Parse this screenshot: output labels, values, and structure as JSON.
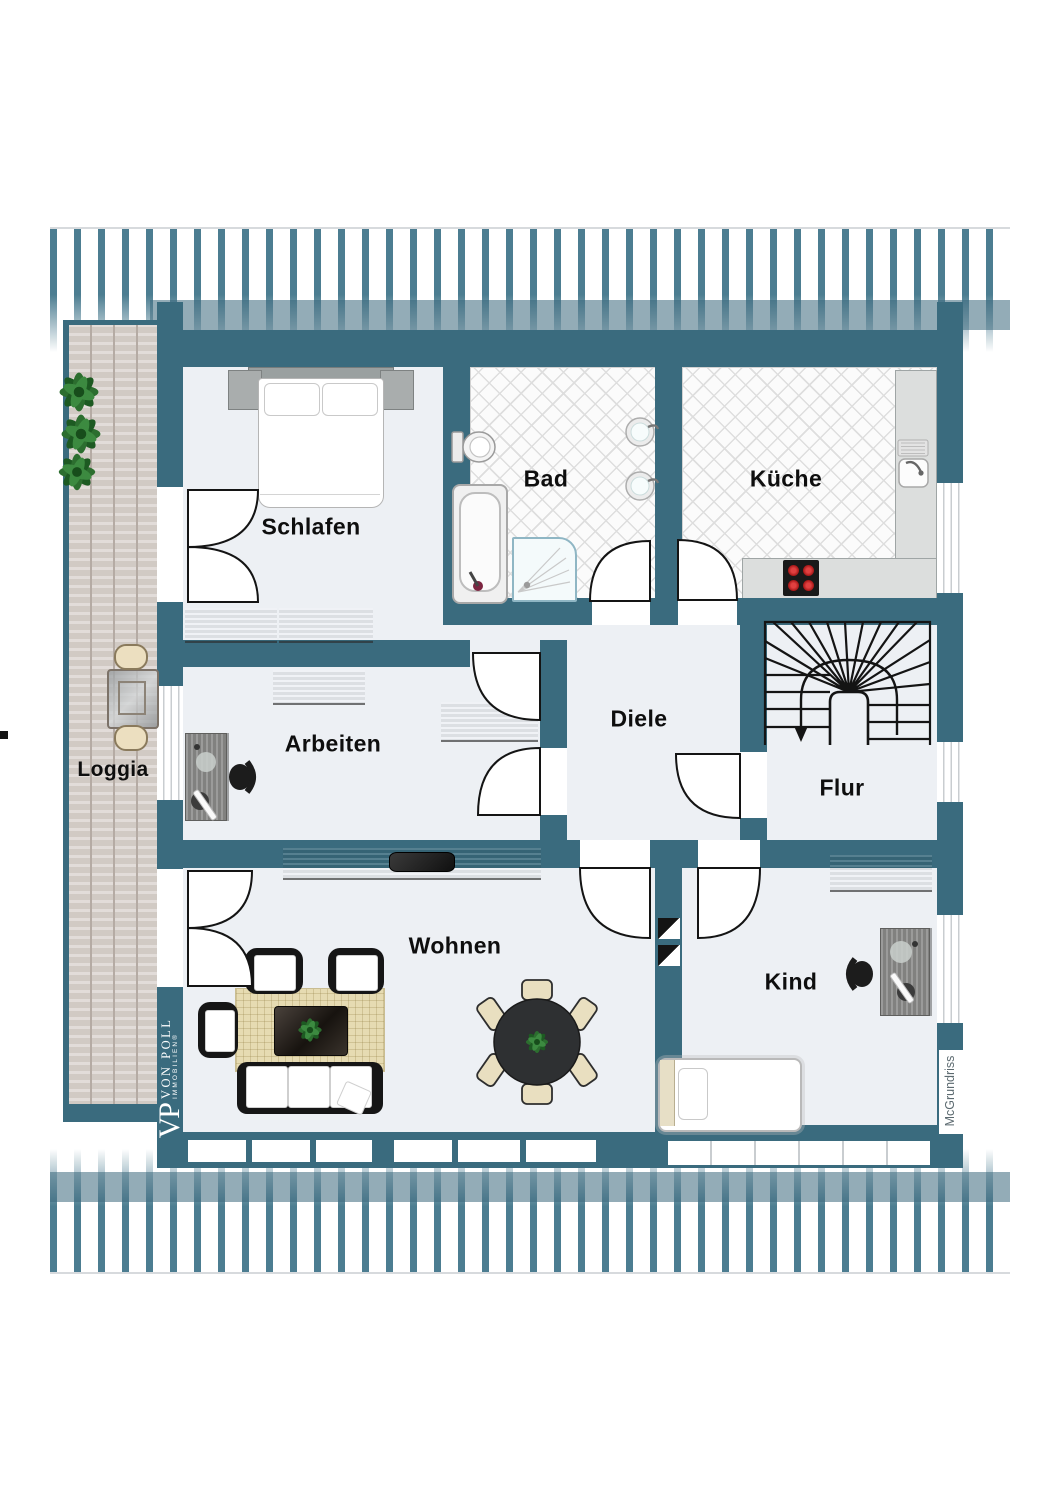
{
  "document": {
    "type": "floor-plan"
  },
  "rooms": {
    "schlafen": {
      "label": "Schlafen"
    },
    "bad": {
      "label": "Bad"
    },
    "kueche": {
      "label": "Küche"
    },
    "diele": {
      "label": "Diele"
    },
    "flur": {
      "label": "Flur"
    },
    "arbeiten": {
      "label": "Arbeiten"
    },
    "wohnen": {
      "label": "Wohnen"
    },
    "kind": {
      "label": "Kind"
    },
    "loggia": {
      "label": "Loggia"
    }
  },
  "branding": {
    "logo_initials": "VP",
    "logo_name": "VON POLL",
    "logo_sub": "IMMOBILIEN®",
    "watermark": "McGrundriss"
  },
  "colors": {
    "wall": "#3a6b7e",
    "stripe": "#4c7d91",
    "floor": "#edf0f4",
    "loggia_wood": "#d8d1cc",
    "rug": "#e6dbb2",
    "chair_beige": "#e9dfc0",
    "stove_burner": "#c02020"
  }
}
